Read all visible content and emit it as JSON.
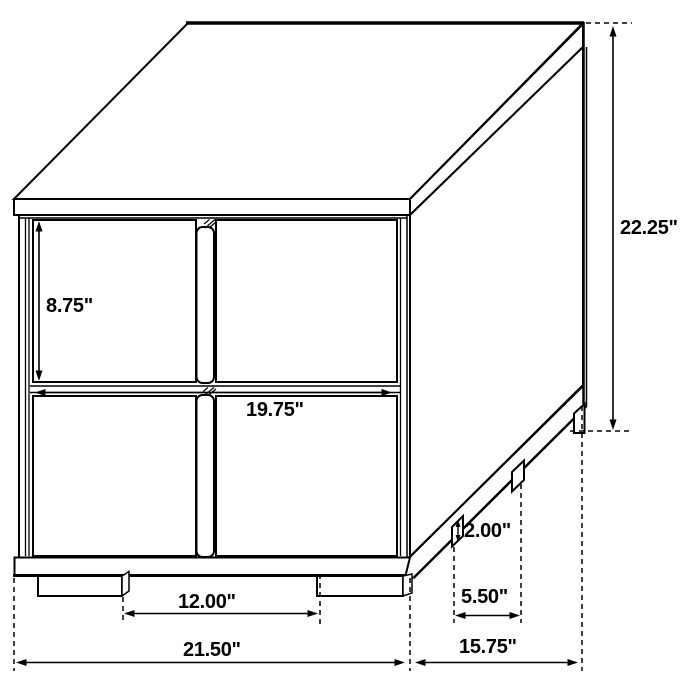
{
  "diagram": {
    "type": "furniture-dimension-drawing",
    "subject": "Two-drawer nightstand isometric line drawing with dimension callouts",
    "unit": "inches",
    "colors": {
      "line": "#000000",
      "background": "#ffffff",
      "text": "#000000"
    },
    "labels": {
      "drawer_opening_height": "8.75\"",
      "drawer_opening_width": "19.75\"",
      "overall_height": "22.25\"",
      "foot_height": "2.00\"",
      "side_foot_gap": "5.50\"",
      "front_foot_gap": "12.00\"",
      "overall_width": "21.50\"",
      "overall_depth": "15.75\""
    },
    "values": {
      "drawer_opening_height_in": 8.75,
      "drawer_opening_width_in": 19.75,
      "overall_height_in": 22.25,
      "foot_height_in": 2.0,
      "side_foot_gap_in": 5.5,
      "front_foot_gap_in": 12.0,
      "overall_width_in": 21.5,
      "overall_depth_in": 15.75
    }
  }
}
